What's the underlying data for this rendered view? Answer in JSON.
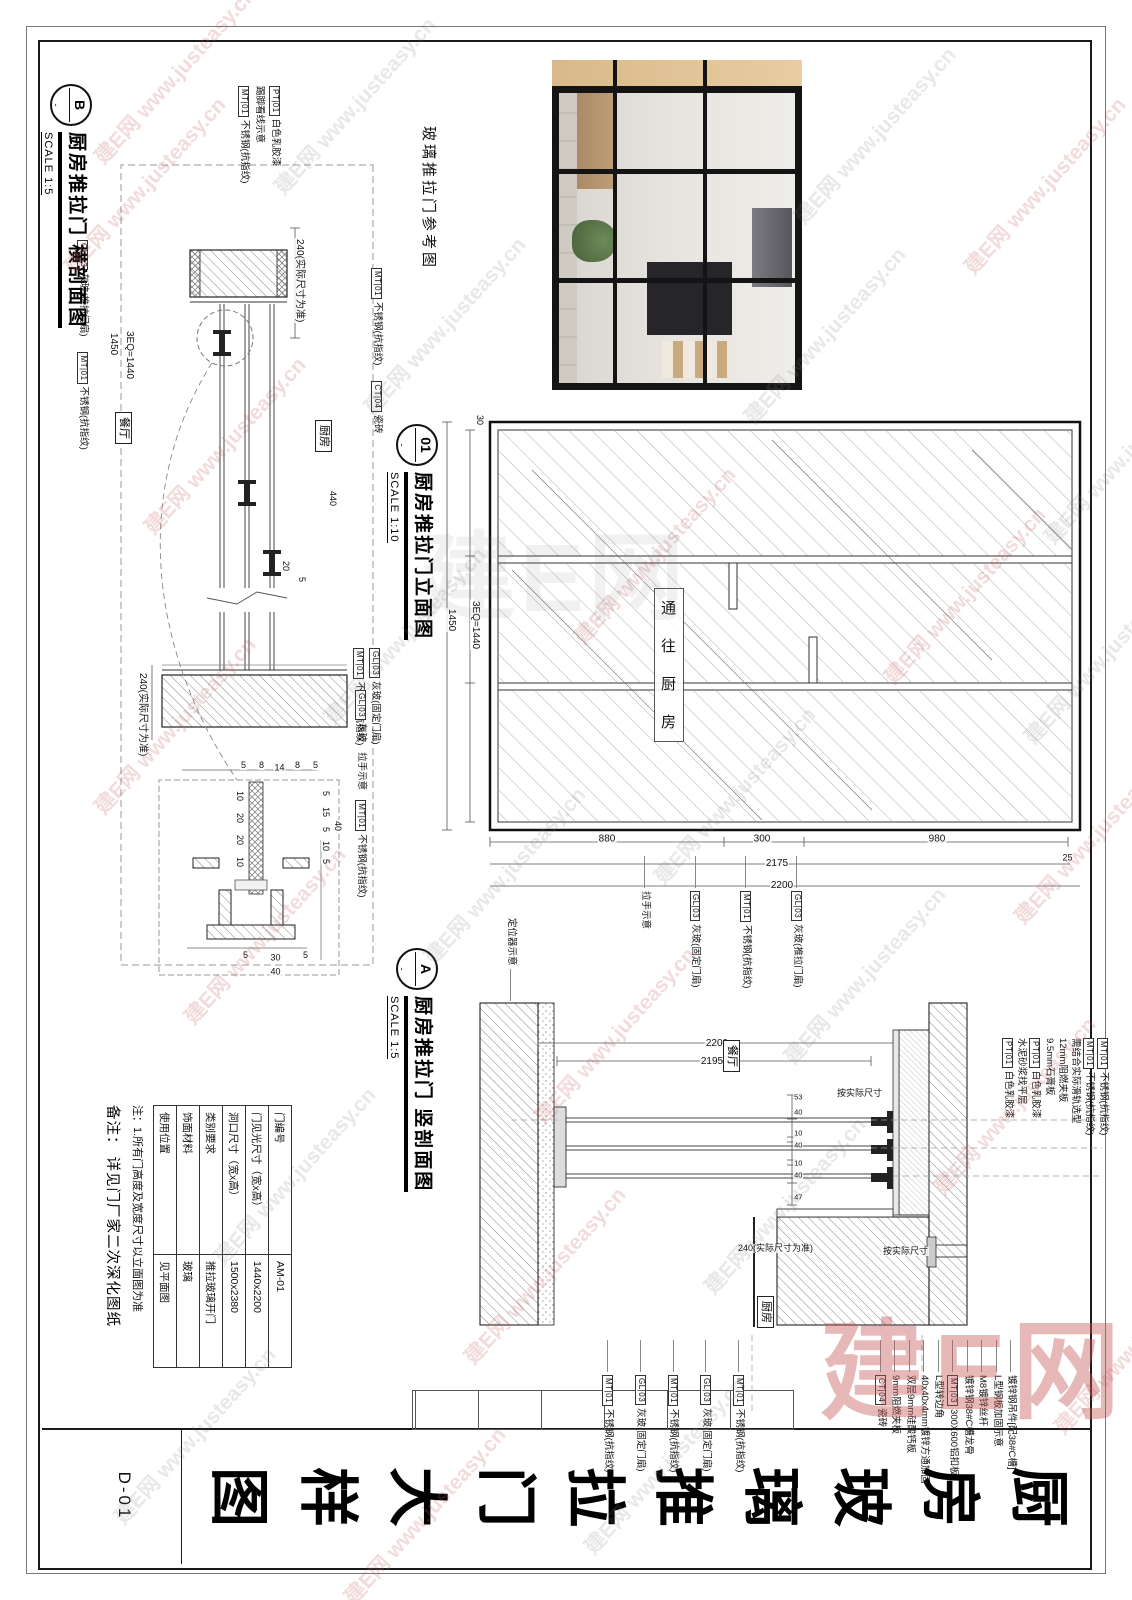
{
  "sheet": {
    "no": "D-01",
    "big_title": "厨房玻璃推拉门大样图",
    "big_title_chars": [
      "厨",
      "房",
      "玻",
      "璃",
      "推",
      "拉",
      "门",
      "大",
      "样",
      "图"
    ]
  },
  "watermark": {
    "brand": "建E网",
    "url": "www.justeasy.cn",
    "full": "建E网 www.justeasy.cn"
  },
  "photo": {
    "caption": "玻璃推拉门参考图"
  },
  "b": {
    "bubble": "B",
    "title": "厨房推拉门 横剖面图",
    "scale": "SCALE 1:5",
    "rooms": {
      "dining": "餐厅",
      "kitchen": "厨房"
    },
    "callouts_top": [
      {
        "tag": "MT|01",
        "text": "不锈钢(抗指纹)"
      },
      {
        "tag": "CT|04",
        "text": "瓷砖"
      }
    ],
    "callouts_left": [
      {
        "tag": "PT|01",
        "text": "白色乳胶漆"
      },
      {
        "tag": "",
        "text": "踢脚看线示意"
      },
      {
        "tag": "MT|01",
        "text": "不锈钢(抗指纹)"
      }
    ],
    "callouts_bottom": [
      {
        "tag": "GL|03",
        "text": "灰玻(推拉门扇)"
      },
      {
        "tag": "MT|01",
        "text": "不锈钢(抗指纹)"
      }
    ],
    "callouts_right": [
      {
        "tag": "GL|03",
        "text": "灰玻(固定门扇)"
      },
      {
        "tag": "MT|01",
        "text": "不锈钢(抗指纹)"
      }
    ],
    "node_callouts": [
      {
        "tag": "GL|03",
        "text": "灰玻"
      },
      {
        "tag": "",
        "text": "拉手示意"
      },
      {
        "tag": "MT|01",
        "text": "不锈钢(抗指纹)"
      }
    ],
    "dims": {
      "wall_left": "240(实际尺寸为准)",
      "wall_right": "240(实际尺寸为准)",
      "span": "3EQ=1440",
      "total": "1450",
      "d440": "440",
      "d20": "20",
      "d5": "5",
      "node_top": [
        "5",
        "15",
        "5",
        "10",
        "5"
      ],
      "node_top_total": "40",
      "node_left": [
        "5",
        "8",
        "14",
        "8",
        "5"
      ],
      "node_right": [
        "5",
        "30",
        "5"
      ],
      "node_right_total": "40",
      "node_mid": [
        "10",
        "20",
        "20",
        "10"
      ]
    }
  },
  "elev": {
    "bubble": "01",
    "title": "厨房推拉门立面图",
    "scale": "SCALE 1:10",
    "glass_note": "通往厨房",
    "glass_note_chars": [
      "通",
      "往",
      "厨",
      "房"
    ],
    "dims": {
      "bottom_inner": "3EQ=1440",
      "bottom_outer": "1450",
      "left_small": "30",
      "top_small": "25",
      "right_chain": [
        "880",
        "300",
        "980"
      ],
      "right_mid": "2175",
      "right_total": "2200"
    },
    "callouts": [
      {
        "tag": "GL|03",
        "text": "灰玻(推拉门扇)"
      },
      {
        "tag": "MT|01",
        "text": "不锈钢(抗指纹)"
      },
      {
        "tag": "GL|03",
        "text": "灰玻(固定门扇)"
      },
      {
        "tag": "",
        "text": "拉手示意"
      }
    ]
  },
  "a": {
    "bubble": "A",
    "title": "厨房推拉门 竖剖面图",
    "scale": "SCALE 1:5",
    "rooms": {
      "dining": "餐厅",
      "kitchen": "厨房"
    },
    "callouts_top": [
      {
        "tag": "MT|01",
        "text": "不锈钢(抗指纹)"
      },
      {
        "tag": "MT|01",
        "text": "不锈钢(抗指纹)"
      },
      {
        "tag": "",
        "text": "需结合实际滑轨选型"
      },
      {
        "tag": "",
        "text": "12mm阻燃夹板"
      },
      {
        "tag": "",
        "text": "9.5mm石膏板"
      },
      {
        "tag": "PT|01",
        "text": "白色乳胶漆"
      },
      {
        "tag": "",
        "text": "水泥砂浆找平层"
      },
      {
        "tag": "PT|01",
        "text": "白色乳胶漆"
      }
    ],
    "callouts_right": [
      {
        "tag": "",
        "text": "镀锌钢吊件[配38#C槽]"
      },
      {
        "tag": "",
        "text": "L型钢板加固示意"
      },
      {
        "tag": "",
        "text": "M8镀锌丝杆"
      },
      {
        "tag": "",
        "text": "镀锌钢38#C槽龙骨"
      },
      {
        "tag": "MT|03",
        "text": "300X600铝扣板"
      },
      {
        "tag": "",
        "text": "L型转边角"
      },
      {
        "tag": "",
        "text": "40x40x4mm镀锌方通加固"
      },
      {
        "tag": "",
        "text": "双层9mm硅酸钙板"
      },
      {
        "tag": "",
        "text": "9mm阻燃夹板"
      },
      {
        "tag": "CT|04",
        "text": "瓷砖"
      }
    ],
    "callouts_bottom": [
      {
        "tag": "MT|01",
        "text": "不锈钢(抗指纹)"
      },
      {
        "tag": "GL|03",
        "text": "灰玻(固定门扇)"
      },
      {
        "tag": "MT|01",
        "text": "不锈钢(抗指纹)"
      },
      {
        "tag": "GL|03",
        "text": "灰玻(固定门扇)"
      },
      {
        "tag": "MT|01",
        "text": "不锈钢(抗指纹)"
      }
    ],
    "callout_floor": {
      "text": "定位器示意"
    },
    "dims": {
      "total": "2200",
      "inner": "2195",
      "fit1": "按实际尺寸",
      "fit2": "按实际尺寸",
      "chain": [
        "53",
        "40",
        "10",
        "40",
        "10",
        "40",
        "47"
      ],
      "chain_note": "240(实际尺寸为准)"
    }
  },
  "spec_table": {
    "rows": [
      [
        "门编号",
        "AM-01"
      ],
      [
        "门见光尺寸（宽x高）",
        "1440x2200"
      ],
      [
        "洞口尺寸（宽x高）",
        "1500x2380"
      ],
      [
        "类别要求",
        "推拉玻璃开门"
      ],
      [
        "饰面材料",
        "玻璃"
      ],
      [
        "使用位置",
        "见平面图"
      ]
    ]
  },
  "notes": {
    "note1": "注：1.所有门高度及宽度尺寸以立面图为准",
    "note2": "备注： 详见门厂家二次深化图纸"
  }
}
